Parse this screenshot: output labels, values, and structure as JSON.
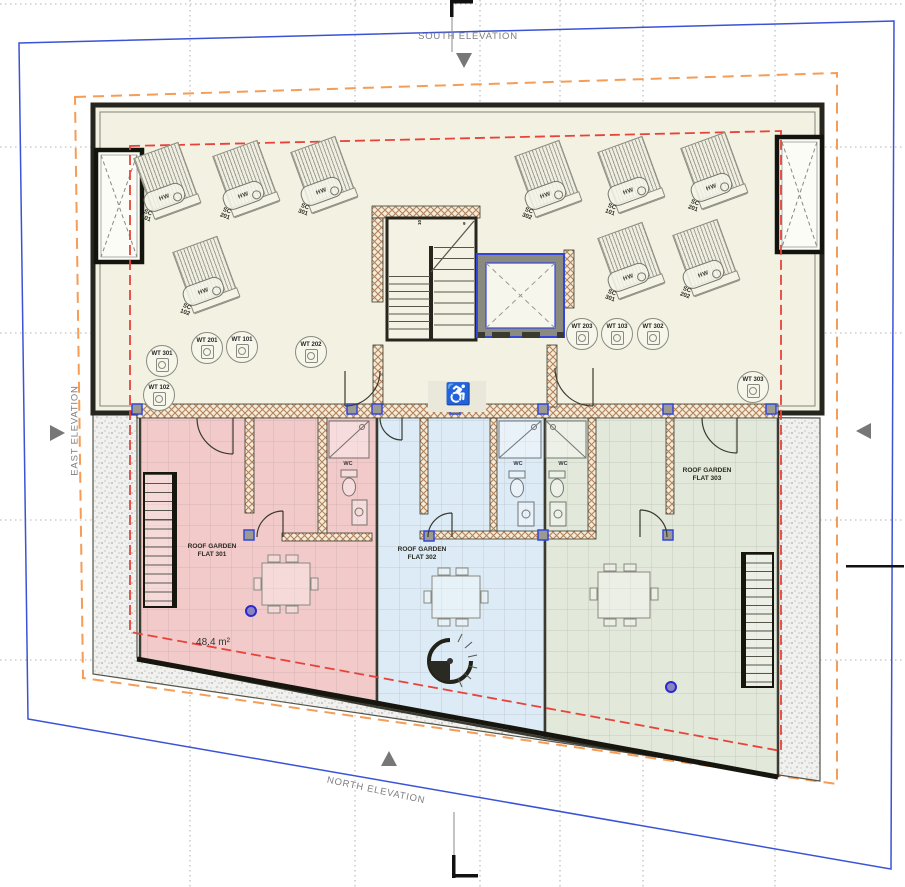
{
  "elevations": {
    "south": "SOUTH ELEVATION",
    "north": "NORTH ELEVATION",
    "east": "EAST ELEVATION",
    "west": "WEST ELEVATION"
  },
  "colors": {
    "site_boundary": "#3a52d6",
    "setback_line": "#f59d56",
    "roof_overhang_line": "#e8433a",
    "flat_301_fill": "#f2caca",
    "flat_302_fill": "#dcebf5",
    "flat_303_fill": "#e2e8da",
    "plant_deck_fill": "#f2f1e2"
  },
  "plant_level": {
    "solar_collectors": [
      {
        "label": "SC\n101",
        "tank": "HW"
      },
      {
        "label": "SC\n201",
        "tank": "HW"
      },
      {
        "label": "SC\n301",
        "tank": "HW"
      },
      {
        "label": "SC\n102",
        "tank": "HW"
      },
      {
        "label": "SC\n302",
        "tank": "HW"
      },
      {
        "label": "SC\n101",
        "tank": "HW"
      },
      {
        "label": "SC\n201",
        "tank": "HW"
      },
      {
        "label": "SC\n301",
        "tank": "HW"
      },
      {
        "label": "SC\n202",
        "tank": "HW"
      }
    ],
    "water_tanks": [
      "WT 301",
      "WT 102",
      "WT 201",
      "WT 101",
      "WT 202",
      "WT 203",
      "WT 103",
      "WT 302",
      "WT 303"
    ],
    "plates_left_col1": [
      "101",
      "101",
      "201",
      "301",
      "301",
      "302",
      "302"
    ],
    "plates_left_col2": [
      "101",
      "201",
      "201",
      "301"
    ],
    "plates_mid_col1": [
      "102",
      "202"
    ],
    "plates_mid_col2": [
      "102",
      "202"
    ],
    "plates_right_grid": [
      "103",
      "103",
      "103",
      "203",
      "203",
      "203",
      "303",
      "303",
      "303"
    ],
    "main_stair": {
      "flight_up_numbers": [
        "11",
        "12",
        "13",
        "14",
        "15",
        "16",
        "17",
        "18"
      ],
      "flight_down_numbers": [
        "8",
        "7",
        "6",
        "5",
        "4",
        "3",
        "2",
        "1"
      ],
      "landing_labels": [
        "10",
        "9"
      ]
    }
  },
  "lobby": {
    "accessible_icon": "♿"
  },
  "roof_gardens": [
    {
      "name": "ROOF GARDEN\nFLAT 301",
      "area": "48.4 m²",
      "wc_label": "WC",
      "stair_numbers": [
        "15",
        "14",
        "13",
        "12",
        "11",
        "10",
        "9",
        "8",
        "7",
        "6",
        "5",
        "4",
        "3",
        "2",
        "1"
      ]
    },
    {
      "name": "ROOF GARDEN\nFLAT 302",
      "wc_label": "WC"
    },
    {
      "name": "ROOF GARDEN\nFLAT 303",
      "wc_label": "WC",
      "stair_numbers": [
        "16",
        "15",
        "14",
        "13",
        "12",
        "11",
        "10",
        "9",
        "8",
        "7",
        "6",
        "5",
        "4",
        "3",
        "2",
        "1"
      ]
    }
  ]
}
